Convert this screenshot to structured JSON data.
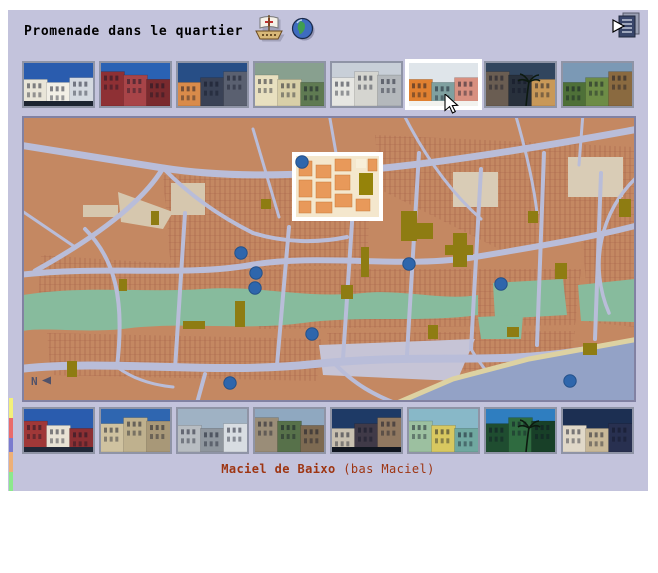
{
  "header": {
    "title": "Promenade dans le quartier",
    "icons": {
      "ship": "caravel ship",
      "globe": "globe world",
      "exit": "exit to index"
    }
  },
  "caption": {
    "name": "Maciel de Baixo",
    "paren": "(bas Maciel)",
    "color": "#9e3512"
  },
  "map": {
    "title": "city district map",
    "compass": "N",
    "highlight": {
      "x": 269,
      "y": 35,
      "w": 91,
      "h": 69
    },
    "markers": [
      {
        "x": 279,
        "y": 45
      },
      {
        "x": 218,
        "y": 136
      },
      {
        "x": 233,
        "y": 156
      },
      {
        "x": 232,
        "y": 171
      },
      {
        "x": 289,
        "y": 217
      },
      {
        "x": 386,
        "y": 147
      },
      {
        "x": 478,
        "y": 167
      },
      {
        "x": 547,
        "y": 264
      },
      {
        "x": 207,
        "y": 266
      }
    ],
    "marker_color": "#2e66ac",
    "land_color": "#c48862",
    "street_color": "#b9bdd9",
    "park_color": "#87bb9d",
    "water_color": "#93a2c6"
  },
  "strip": [
    {
      "color": "#f3f07a",
      "height": 20
    },
    {
      "color": "#ea6a6a",
      "height": 20
    },
    {
      "color": "#7a7ace",
      "height": 14
    },
    {
      "color": "#edb078",
      "height": 20
    },
    {
      "color": "#8ce98c",
      "height": 19
    }
  ],
  "selected_top_index": 5,
  "top_thumbnails": [
    {
      "alt": "white colonial facades under blue sky",
      "sky": "#2a5cae",
      "buildings": [
        "#e9e5d8",
        "#f2efe6",
        "#d4d9e0"
      ],
      "ground": "#1c2430"
    },
    {
      "alt": "red colonial mansion",
      "sky": "#2a62b4",
      "buildings": [
        "#8e3034",
        "#a84448",
        "#7a2a2e"
      ]
    },
    {
      "alt": "street with orange house and dark buildings",
      "sky": "#274e86",
      "buildings": [
        "#d98b4a",
        "#3a4256",
        "#5a6070"
      ]
    },
    {
      "alt": "twin-tower church among trees",
      "sky": "#88a08f",
      "buildings": [
        "#e8e0c0",
        "#d8cfa8",
        "#5f7a52"
      ]
    },
    {
      "alt": "pale town with hilltop church",
      "sky": "#c8cfd8",
      "buildings": [
        "#e6e6e2",
        "#d5d5d0",
        "#b4b8bc"
      ]
    },
    {
      "alt": "orange houses on whitewashed lane",
      "sky": "#dfe5ea",
      "buildings": [
        "#e08030",
        "#7fa0a0",
        "#d89080"
      ],
      "ground": "#f2f2ee"
    },
    {
      "alt": "dark houses with palm at dusk",
      "sky": "#31455e",
      "buildings": [
        "#6a5d52",
        "#28303c",
        "#c89858"
      ],
      "palm": true
    },
    {
      "alt": "green hillside with ruins",
      "sky": "#7b99b5",
      "buildings": [
        "#4e7038",
        "#6d8c46",
        "#8a6a40"
      ]
    }
  ],
  "bottom_thumbnails": [
    {
      "alt": "red and white colonial house",
      "sky": "#2a5cae",
      "buildings": [
        "#a03838",
        "#e8e2d4",
        "#8c2f33"
      ],
      "ground": "#202838"
    },
    {
      "alt": "ruined beige building",
      "sky": "#2f66b0",
      "buildings": [
        "#cfc2a0",
        "#bfb18e",
        "#a89878"
      ]
    },
    {
      "alt": "grey baroque church facade",
      "sky": "#9fb2c4",
      "buildings": [
        "#b8bdc2",
        "#8f969e",
        "#d8dde2"
      ]
    },
    {
      "alt": "overgrown ruined houses",
      "sky": "#8fa8c0",
      "buildings": [
        "#9a8d78",
        "#57714a",
        "#7d6a52"
      ]
    },
    {
      "alt": "dark street of colonial houses",
      "sky": "#1e3a66",
      "buildings": [
        "#c8c0b0",
        "#403a48",
        "#907860"
      ],
      "ground": "#101620"
    },
    {
      "alt": "green and yellow facades",
      "sky": "#88b8c8",
      "buildings": [
        "#9cc0a0",
        "#d8c860",
        "#70a8a0"
      ]
    },
    {
      "alt": "fountain square with palm trees",
      "sky": "#2f7ec0",
      "buildings": [
        "#1f4d30",
        "#2f6b40",
        "#184028"
      ],
      "palm": true
    },
    {
      "alt": "white house against dusk sky",
      "sky": "#1c2f52",
      "buildings": [
        "#e0d8c8",
        "#c8b898",
        "#283050"
      ]
    }
  ]
}
